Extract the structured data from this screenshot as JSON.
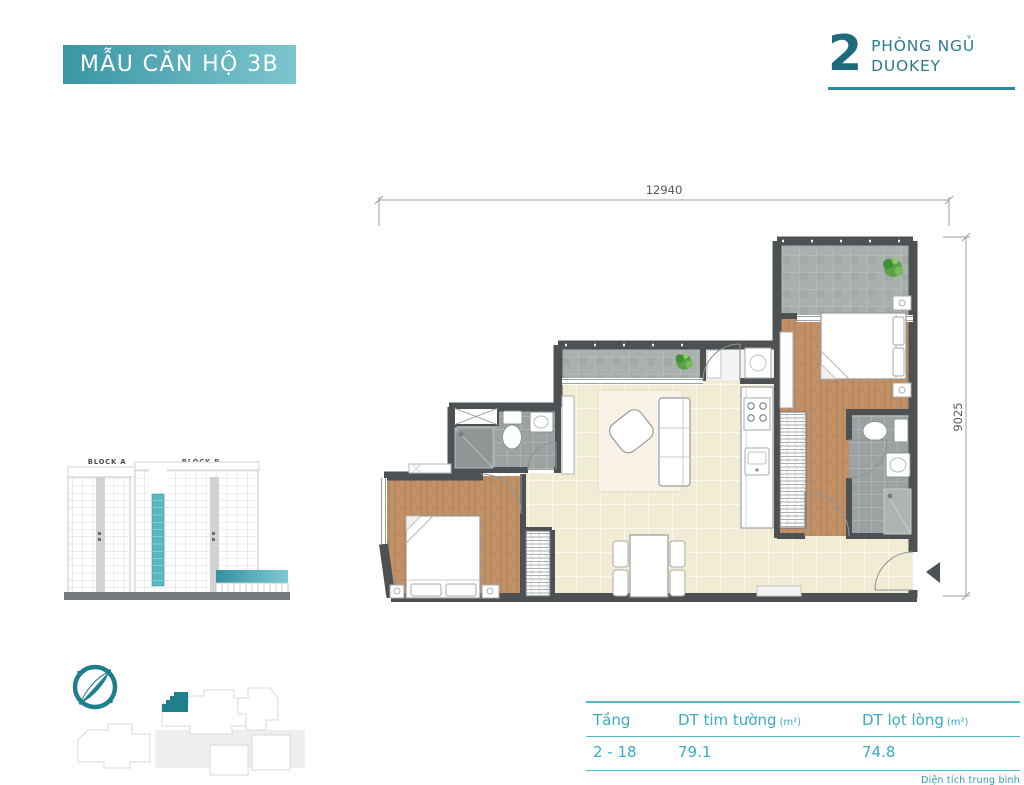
{
  "header": {
    "badge": {
      "label": "MẪU CĂN HỘ 3B",
      "bg_from": "#3a96a4",
      "bg_to": "#7cc5ce",
      "text_color": "#ffffff"
    },
    "unit": {
      "number": "2",
      "line1": "PHÒNG NGỦ",
      "line2": "DUOKEY",
      "color": "#1d6a7c",
      "rule_color": "#2e8a9b"
    }
  },
  "plan": {
    "dim_width": "12940",
    "dim_height": "9025",
    "wall_color": "#4e5154",
    "wood_color": "#c29067",
    "tile_color": "#f3ecd4",
    "bath_tile_color": "#9ba2a1",
    "balcony_tile_color": "#aab0ae"
  },
  "elevation": {
    "block_a": "BLOCK A",
    "block_b": "BLOCK B",
    "highlight_color": "#58b8c3"
  },
  "site_plan": {
    "highlight_color": "#1f7f8c"
  },
  "compass": {
    "color": "#1e7e8b"
  },
  "icons": {
    "compass": "compass-icon",
    "plant": "plant-icon",
    "entrance_arrow": "◀"
  },
  "table": {
    "headers": [
      {
        "label": "Tầng",
        "unit": ""
      },
      {
        "label": "DT tim tường",
        "unit": "(m²)"
      },
      {
        "label": "DT lọt lòng",
        "unit": "(m²)"
      }
    ],
    "row": {
      "floor_range": "2 - 18",
      "area_gross": "79.1",
      "area_net": "74.8"
    },
    "footnote": "Diện tích trung bình",
    "text_color": "#38adc2",
    "line_color": "#4fbac9"
  }
}
